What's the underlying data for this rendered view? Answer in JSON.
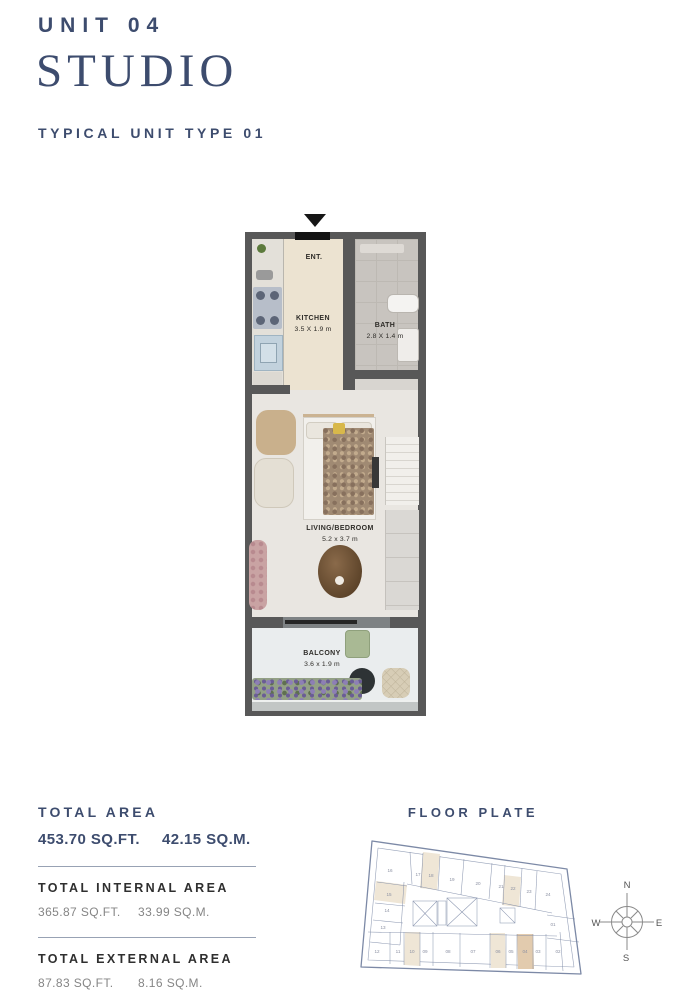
{
  "header": {
    "unit": "UNIT 04",
    "type_name": "STUDIO",
    "subtitle": "TYPICAL UNIT TYPE 01"
  },
  "floor_plan": {
    "entrance_label": "ENT.",
    "rooms": [
      {
        "name": "KITCHEN",
        "dims": "3.5 X 1.9 m"
      },
      {
        "name": "BATH",
        "dims": "2.8 X 1.4 m"
      },
      {
        "name": "LIVING/BEDROOM",
        "dims": "5.2 x 3.7 m"
      },
      {
        "name": "BALCONY",
        "dims": "3.6 x 1.9 m"
      }
    ]
  },
  "areas": {
    "total": {
      "label": "TOTAL AREA",
      "sqft": "453.70 SQ.FT.",
      "sqm": "42.15 SQ.M."
    },
    "internal": {
      "label": "TOTAL INTERNAL AREA",
      "sqft": "365.87 SQ.FT.",
      "sqm": "33.99 SQ.M."
    },
    "external": {
      "label": "TOTAL EXTERNAL AREA",
      "sqft": "87.83 SQ.FT.",
      "sqm": "8.16 SQ.M."
    }
  },
  "floor_plate": {
    "title": "FLOOR PLATE",
    "current_unit": "04",
    "units": [
      {
        "label": "16",
        "highlight": "none"
      },
      {
        "label": "17",
        "highlight": "none"
      },
      {
        "label": "18",
        "highlight": "light"
      },
      {
        "label": "19",
        "highlight": "none"
      },
      {
        "label": "20",
        "highlight": "none"
      },
      {
        "label": "21",
        "highlight": "none"
      },
      {
        "label": "22",
        "highlight": "light"
      },
      {
        "label": "23",
        "highlight": "none"
      },
      {
        "label": "24",
        "highlight": "none"
      },
      {
        "label": "15",
        "highlight": "light"
      },
      {
        "label": "14",
        "highlight": "none"
      },
      {
        "label": "13",
        "highlight": "none"
      },
      {
        "label": "01",
        "highlight": "none"
      },
      {
        "label": "12",
        "highlight": "none"
      },
      {
        "label": "11",
        "highlight": "none"
      },
      {
        "label": "10",
        "highlight": "light"
      },
      {
        "label": "09",
        "highlight": "none"
      },
      {
        "label": "08",
        "highlight": "none"
      },
      {
        "label": "07",
        "highlight": "none"
      },
      {
        "label": "06",
        "highlight": "light"
      },
      {
        "label": "05",
        "highlight": "none"
      },
      {
        "label": "04",
        "highlight": "current"
      },
      {
        "label": "03",
        "highlight": "none"
      },
      {
        "label": "02",
        "highlight": "none"
      }
    ],
    "compass": {
      "n": "N",
      "e": "E",
      "s": "S",
      "w": "W"
    }
  },
  "colors": {
    "navy": "#3d4c6e",
    "wall": "#585858",
    "kitchen_floor": "#ece3d1",
    "bath_floor": "#c8c4bf",
    "living_floor": "#e9e6e1",
    "balcony_floor": "#eaedee",
    "plate_outline": "#7c89a6",
    "highlight": "#efe6d6",
    "highlight_current": "#e2cbae"
  }
}
